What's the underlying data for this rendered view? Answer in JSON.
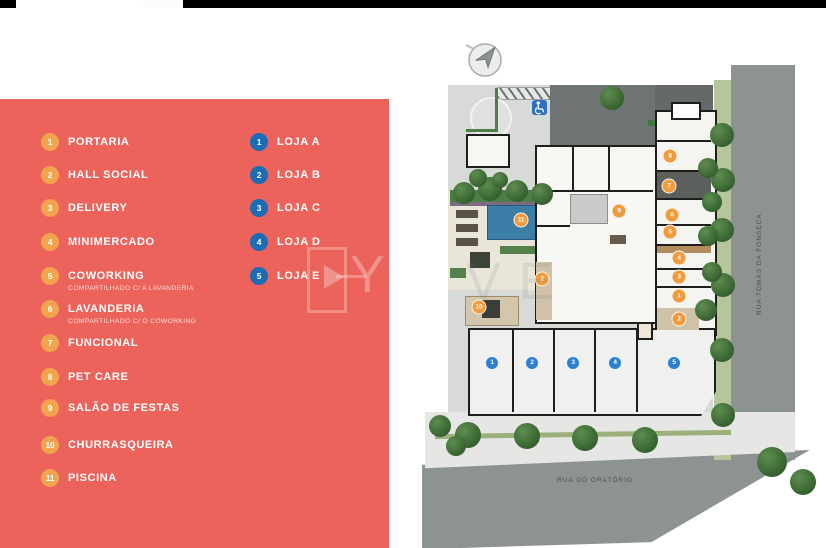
{
  "legend": {
    "amenities": [
      {
        "num": "1",
        "label": "PORTARIA"
      },
      {
        "num": "2",
        "label": "HALL SOCIAL"
      },
      {
        "num": "3",
        "label": "DELIVERY"
      },
      {
        "num": "4",
        "label": "MINIMERCADO"
      },
      {
        "num": "5",
        "label": "COWORKING",
        "sublabel": "COMPARTILHADO C/ A LAVANDERIA"
      },
      {
        "num": "6",
        "label": "LAVANDERIA",
        "sublabel": "COMPARTILHADO C/ O COWORKING"
      },
      {
        "num": "7",
        "label": "FUNCIONAL"
      },
      {
        "num": "8",
        "label": "PET CARE"
      },
      {
        "num": "9",
        "label": "SALÃO DE FESTAS"
      },
      {
        "num": "10",
        "label": "CHURRASQUEIRA"
      },
      {
        "num": "11",
        "label": "PISCINA"
      }
    ],
    "lojas": [
      {
        "num": "1",
        "label": "LOJA A"
      },
      {
        "num": "2",
        "label": "LOJA B"
      },
      {
        "num": "3",
        "label": "LOJA C"
      },
      {
        "num": "4",
        "label": "LOJA D"
      },
      {
        "num": "5",
        "label": "LOJA E"
      }
    ]
  },
  "site_plan": {
    "streets": {
      "right_street": "RUA TOMÁS DA FONSECA",
      "bottom_street": "RUA DO ORATÓRIO"
    },
    "amenity_markers": [
      {
        "num": "11",
        "x": 101,
        "y": 190
      },
      {
        "num": "9",
        "x": 199,
        "y": 181
      },
      {
        "num": "8",
        "x": 250,
        "y": 126
      },
      {
        "num": "7",
        "x": 249,
        "y": 156
      },
      {
        "num": "6",
        "x": 252,
        "y": 185
      },
      {
        "num": "5",
        "x": 250,
        "y": 202
      },
      {
        "num": "4",
        "x": 259,
        "y": 228
      },
      {
        "num": "3",
        "x": 259,
        "y": 247
      },
      {
        "num": "1",
        "x": 259,
        "y": 266
      },
      {
        "num": "2",
        "x": 259,
        "y": 289
      },
      {
        "num": "2",
        "x": 122,
        "y": 249
      },
      {
        "num": "10",
        "x": 59,
        "y": 277
      }
    ],
    "loja_markers": [
      {
        "num": "1",
        "x": 72,
        "y": 333
      },
      {
        "num": "2",
        "x": 112,
        "y": 333
      },
      {
        "num": "3",
        "x": 153,
        "y": 333
      },
      {
        "num": "4",
        "x": 195,
        "y": 333
      },
      {
        "num": "5",
        "x": 254,
        "y": 333
      }
    ],
    "icons": [
      "north-compass-icon",
      "accessible-parking-icon",
      "shopping-cart-icon"
    ]
  },
  "watermark": {
    "panel_letter": "Y",
    "plan_letters": "VE"
  },
  "colors": {
    "panel_red": "#ec635b",
    "amenity_orange": "#f2a34d",
    "loja_legend_blue": "#1a6db4",
    "loja_marker_blue": "#2e7fd0",
    "road_gray": "#8d9293",
    "pool_blue": "#3d7ea9"
  }
}
